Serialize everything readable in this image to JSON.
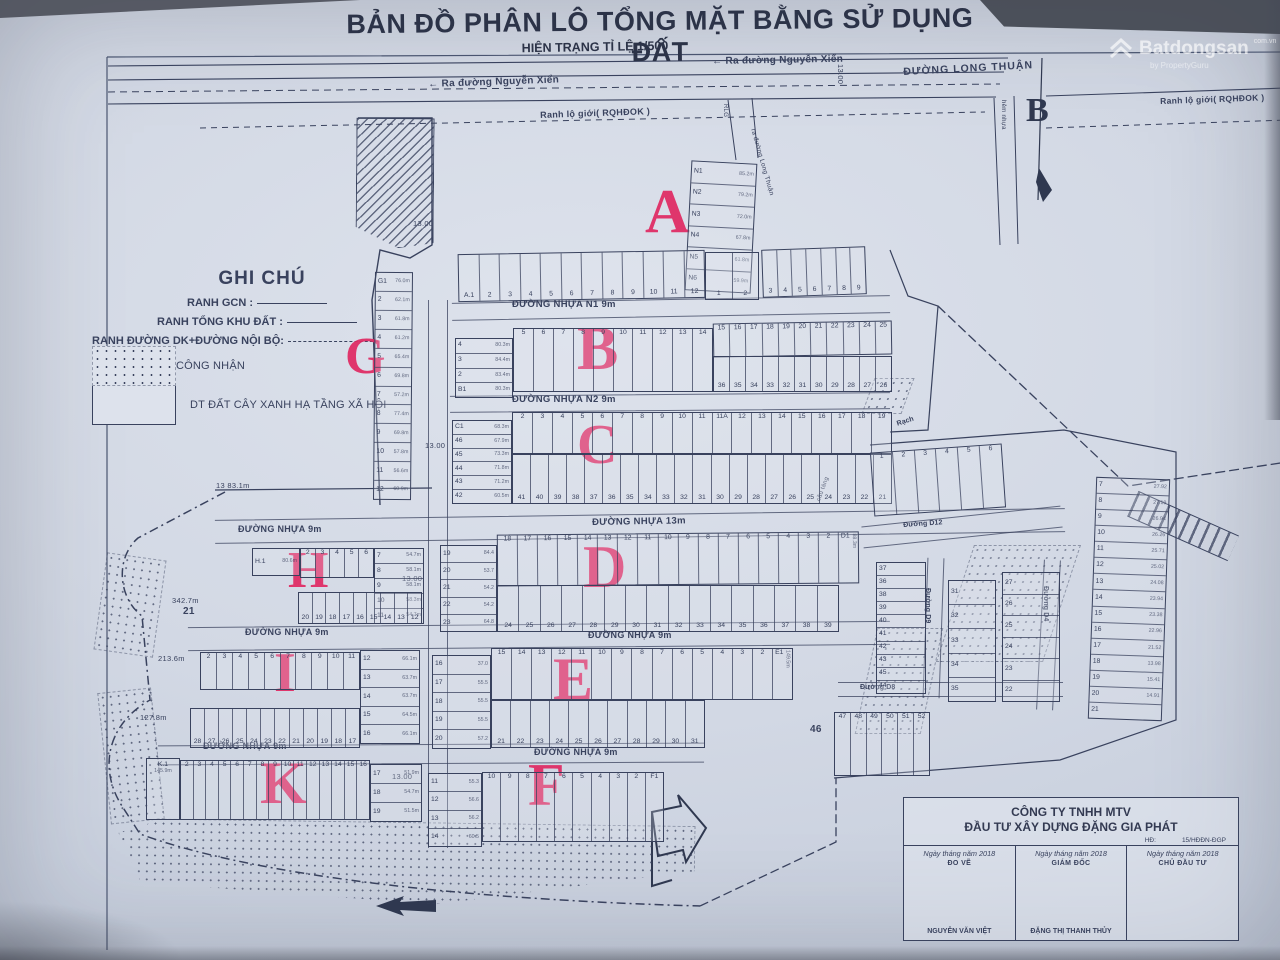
{
  "header": {
    "title": "BẢN ĐỒ PHÂN LÔ TỔNG MẶT BẰNG SỬ DỤNG ĐẤT",
    "subtitle": "HIỆN TRẠNG TỈ LỆ 1/500"
  },
  "watermark": {
    "brand": "Batdongsan",
    "domain": "com.vn",
    "tagline": "by PropertyGuru"
  },
  "compass": {
    "label": "B"
  },
  "legend": {
    "title": "GHI CHÚ",
    "line1": "RANH GCN :",
    "line2": "RANH TỔNG KHU ĐẤT :",
    "line3": "RANH ĐƯỜNG DK+ĐƯỜNG NỘI BỘ:",
    "swatch1": "ĐẤT NN ĐƯỢC CÔNG NHẬN",
    "swatch2": "DT ĐẤT CÂY XANH HẠ TẦNG XÃ HỘI"
  },
  "top": {
    "arrow": "←",
    "ra_nguyen_xien": "Ra đường Nguyễn Xiển",
    "long_thuan": "ĐƯỜNG LONG THUẬN",
    "ranh_lo_gioi": "Ranh lộ giới( RQHĐOK )",
    "hem_nhua": "hẻm nhựa",
    "ra_long_thuan": "ra đường Long Thuận",
    "rlg": "RLG"
  },
  "streets": {
    "n1": "ĐƯỜNG NHỰA N1  9m",
    "n2": "ĐƯỜNG NHỰA N2  9m",
    "m13": "ĐƯỜNG NHỰA  13m",
    "m9": "ĐƯỜNG NHỰA 9m",
    "d12": "Đường D12",
    "d9": "Đường D9",
    "d8": "Đường D8",
    "d4": "Đường D4",
    "rach": "Rạch",
    "cau": "cầu tàng"
  },
  "dims": {
    "d13": "13.00",
    "g13n": "13",
    "g13a": "83.1m",
    "i1": "213.6m",
    "i2": "127.8m",
    "h21n": "21",
    "h21a": "342.7m",
    "p46": "46"
  },
  "blocks": {
    "a": {
      "letter": "A",
      "lots": [
        {
          "n": "N1",
          "a": "85.2m"
        },
        {
          "n": "N2",
          "a": "79.2m"
        },
        {
          "n": "N3",
          "a": "72.0m"
        },
        {
          "n": "N4",
          "a": "67.8m"
        },
        {
          "n": "N5",
          "a": "61.8m"
        },
        {
          "n": "N6",
          "a": "59.9m"
        }
      ]
    },
    "a_row": {
      "cells": [
        "A.1",
        "2",
        "3",
        "4",
        "5",
        "6",
        "7",
        "8",
        "9",
        "10",
        "11",
        "12"
      ],
      "pair": [
        "1",
        "2"
      ],
      "right": [
        "3",
        "4",
        "5",
        "6",
        "7",
        "8",
        "9"
      ]
    },
    "b": {
      "letter": "B",
      "left": [
        {
          "n": "4",
          "a": "80.3m"
        },
        {
          "n": "3",
          "a": "84.4m"
        },
        {
          "n": "2",
          "a": "83.4m"
        },
        {
          "n": "B1",
          "a": "80.3m"
        }
      ],
      "mid": [
        "5",
        "6",
        "7",
        "8",
        "9",
        "10",
        "11",
        "12",
        "13",
        "14"
      ],
      "top": [
        "15",
        "16",
        "17",
        "18",
        "19",
        "20",
        "21",
        "22",
        "23",
        "24",
        "25"
      ],
      "bottom": [
        "36",
        "35",
        "34",
        "33",
        "32",
        "31",
        "30",
        "29",
        "28",
        "27",
        "26"
      ]
    },
    "c": {
      "letter": "C",
      "left": [
        {
          "n": "C1",
          "a": "68.3m"
        },
        {
          "n": "46",
          "a": "67.9m"
        },
        {
          "n": "45",
          "a": "73.3m"
        },
        {
          "n": "44",
          "a": "71.8m"
        },
        {
          "n": "43",
          "a": "71.2m"
        },
        {
          "n": "42",
          "a": "60.5m"
        }
      ],
      "top": [
        "2",
        "3",
        "4",
        "5",
        "6",
        "7",
        "8",
        "9",
        "10",
        "11",
        "11A",
        "12",
        "13",
        "14",
        "15",
        "16",
        "17",
        "18",
        "19"
      ],
      "bottom": [
        "41",
        "40",
        "39",
        "38",
        "37",
        "36",
        "35",
        "34",
        "33",
        "32",
        "31",
        "30",
        "29",
        "28",
        "27",
        "26",
        "25",
        "24",
        "23",
        "22",
        "21"
      ]
    },
    "d": {
      "letter": "D",
      "left": [
        {
          "n": "19",
          "a": "84.4"
        },
        {
          "n": "20",
          "a": "53.7"
        },
        {
          "n": "21",
          "a": "54.2"
        },
        {
          "n": "22",
          "a": "54.2"
        },
        {
          "n": "23",
          "a": "64.8"
        }
      ],
      "top": [
        "18",
        "17",
        "16",
        "15",
        "14",
        "13",
        "12",
        "11",
        "10",
        "9",
        "8",
        "7",
        "6",
        "5",
        "4",
        "3",
        "2",
        {
          "n": "D1",
          "a": "88.3m"
        }
      ],
      "bottom": [
        "24",
        "25",
        "26",
        "27",
        "28",
        "29",
        "30",
        "31",
        "32",
        "33",
        "34",
        "35",
        "36",
        "37",
        "38",
        "39"
      ]
    },
    "e": {
      "letter": "E",
      "left": [
        {
          "n": "16",
          "a": "37.0"
        },
        {
          "n": "17",
          "a": "55.5"
        },
        {
          "n": "18",
          "a": "55.5"
        },
        {
          "n": "19",
          "a": "55.5"
        },
        {
          "n": "20",
          "a": "57.2"
        }
      ],
      "top": [
        "15",
        "14",
        "13",
        "12",
        "11",
        "10",
        "9",
        "8",
        "7",
        "6",
        "5",
        "4",
        "3",
        "2",
        {
          "n": "E1",
          "a": "149.5m"
        }
      ],
      "bottom": [
        "21",
        "22",
        "23",
        "24",
        "25",
        "26",
        "27",
        "28",
        "29",
        "30",
        "31"
      ]
    },
    "f": {
      "letter": "F",
      "left": [
        {
          "n": "11",
          "a": "55.3"
        },
        {
          "n": "12",
          "a": "56.6"
        },
        {
          "n": "13",
          "a": "56.2"
        },
        {
          "n": "14",
          "a": "60.5"
        }
      ],
      "row": [
        "10",
        "9",
        "8",
        "7",
        "6",
        "5",
        "4",
        "3",
        "2",
        "F1"
      ]
    },
    "g": {
      "letter": "G",
      "lots": [
        {
          "n": "G1",
          "a": "76.0m"
        },
        {
          "n": "2",
          "a": "62.1m"
        },
        {
          "n": "3",
          "a": "61.8m"
        },
        {
          "n": "4",
          "a": "61.2m"
        },
        {
          "n": "5",
          "a": "65.4m"
        },
        {
          "n": "6",
          "a": "69.8m"
        },
        {
          "n": "7",
          "a": "57.2m"
        },
        {
          "n": "8",
          "a": "77.4m"
        },
        {
          "n": "9",
          "a": "69.8m"
        },
        {
          "n": "10",
          "a": "57.8m"
        },
        {
          "n": "11",
          "a": "56.6m"
        },
        {
          "n": "12",
          "a": "60.9m"
        }
      ]
    },
    "h": {
      "letter": "H",
      "left": [
        {
          "n": "H.1",
          "a": "80.6m"
        }
      ],
      "top": [
        "2",
        "3",
        "4",
        "5",
        "6"
      ],
      "right": [
        {
          "n": "7",
          "a": "54.7m"
        },
        {
          "n": "8",
          "a": "58.1m"
        },
        {
          "n": "9",
          "a": "58.1m"
        },
        {
          "n": "10",
          "a": "58.3m"
        },
        {
          "n": "11",
          "a": "54.7m"
        }
      ],
      "bottom": [
        "20",
        "19",
        "18",
        "17",
        "16",
        "15",
        "14",
        "13",
        "12"
      ]
    },
    "i": {
      "letter": "I",
      "top": [
        "2",
        "3",
        "4",
        "5",
        "6",
        "7",
        "8",
        "9",
        "10",
        "11"
      ],
      "right": [
        {
          "n": "12",
          "a": "66.1m"
        },
        {
          "n": "13",
          "a": "63.7m"
        },
        {
          "n": "14",
          "a": "63.7m"
        },
        {
          "n": "15",
          "a": "64.5m"
        },
        {
          "n": "16",
          "a": "66.1m"
        }
      ],
      "bottom": [
        "28",
        "27",
        "26",
        "25",
        "24",
        "23",
        "22",
        "21",
        "20",
        "19",
        "18",
        "17"
      ]
    },
    "k": {
      "letter": "K",
      "left": [
        {
          "n": "K.1",
          "a": "145.9m"
        }
      ],
      "row": [
        "2",
        "3",
        "4",
        "5",
        "6",
        "7",
        "8",
        "9",
        "10",
        "11",
        "12",
        "13",
        "14",
        "15",
        "16"
      ],
      "right": [
        {
          "n": "17",
          "a": "51.9m"
        },
        {
          "n": "18",
          "a": "54.7m"
        },
        {
          "n": "19",
          "a": "51.5m"
        }
      ]
    },
    "east": {
      "row": [
        "1",
        "2",
        "3",
        "4",
        "5",
        "6"
      ],
      "col": [
        {
          "n": "7",
          "a": "27.92"
        },
        {
          "n": "8",
          "a": "27.19"
        },
        {
          "n": "9",
          "a": "26.94"
        },
        {
          "n": "10",
          "a": "26.26"
        },
        {
          "n": "11",
          "a": "25.71"
        },
        {
          "n": "12",
          "a": "25.02"
        },
        {
          "n": "13",
          "a": "24.08"
        },
        {
          "n": "14",
          "a": "23.94"
        },
        {
          "n": "15",
          "a": "23.38"
        },
        {
          "n": "16",
          "a": "22.96"
        },
        {
          "n": "17",
          "a": "21.52"
        },
        {
          "n": "18",
          "a": "13.98"
        },
        {
          "n": "19",
          "a": "15.41"
        },
        {
          "n": "20",
          "a": "14.91"
        },
        {
          "n": "21",
          "a": ""
        }
      ],
      "grid_a": [
        "37",
        "36",
        "38",
        "39",
        "40",
        "41",
        "42",
        "43",
        "45",
        "44"
      ],
      "grid_b": [
        "31",
        "32",
        "33",
        "34",
        "35"
      ],
      "grid_c": [
        "27",
        "26",
        "25",
        "24",
        "23",
        "22"
      ],
      "bottom": [
        "47",
        "48",
        "49",
        "50",
        "51",
        "52"
      ]
    }
  },
  "table": {
    "company1": "CÔNG TY TNHH MTV",
    "company2": "ĐẦU TƯ XÂY DỰNG ĐẶNG GIA PHÁT",
    "hd": "HĐ:",
    "hd_no": "15/HĐĐN-ĐGP",
    "cols": [
      {
        "date": "Ngày   tháng   năm 2018",
        "role": "ĐO VẼ",
        "name": "NGUYỄN VĂN VIỆT"
      },
      {
        "date": "Ngày   tháng   năm 2018",
        "role": "GIÁM ĐỐC",
        "name": "ĐẶNG THỊ THANH THỦY"
      },
      {
        "date": "Ngày   tháng   năm 2018",
        "role": "CHỦ ĐẦU TƯ",
        "name": ""
      }
    ]
  }
}
